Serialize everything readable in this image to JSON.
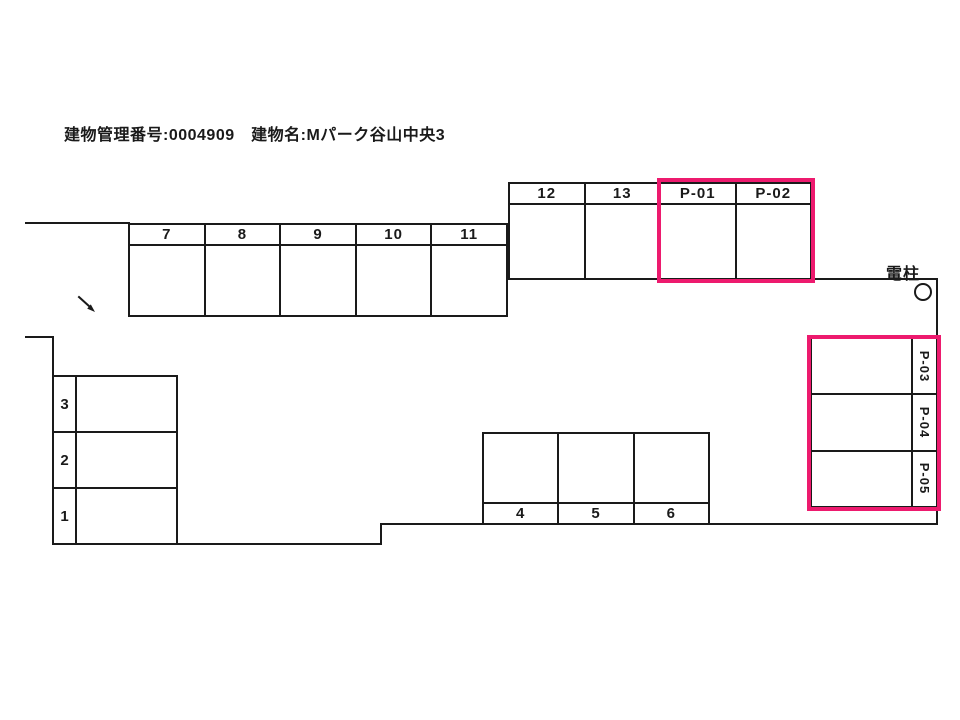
{
  "header": {
    "title": "建物管理番号:0004909　建物名:Mパーク谷山中央3"
  },
  "colors": {
    "line": "#1A1A1A",
    "highlight_pink": "#ED1A6E",
    "background": "#FFFFFF"
  },
  "annotations": {
    "utility_pole": "電柱",
    "entrance_arrow_icon": "arrow-down-right"
  },
  "lots": {
    "row_upper": {
      "cells": [
        "12",
        "13",
        "P-01",
        "P-02"
      ],
      "highlighted_cells": [
        "P-01",
        "P-02"
      ]
    },
    "row_mid": {
      "cells": [
        "7",
        "8",
        "9",
        "10",
        "11"
      ]
    },
    "stack_left": {
      "cells": [
        "3",
        "2",
        "1"
      ]
    },
    "block_bottom": {
      "cells": [
        "4",
        "5",
        "6"
      ]
    },
    "stack_right": {
      "cells": [
        "P-03",
        "P-04",
        "P-05"
      ],
      "highlighted_cells": [
        "P-03",
        "P-04",
        "P-05"
      ]
    }
  }
}
